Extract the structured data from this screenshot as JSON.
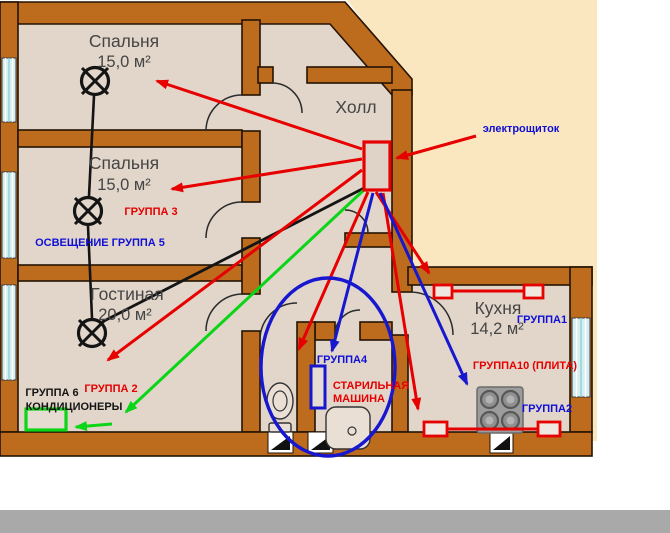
{
  "diagram": {
    "title": "apartment-electrical-wiring-plan",
    "rooms": {
      "bedroom1": {
        "name": "Спальня",
        "area": "15,0 м²"
      },
      "bedroom2": {
        "name": "Спальня",
        "area": "15,0 м²"
      },
      "living": {
        "name": "Гостиная",
        "area": "20,0 м²"
      },
      "hall": {
        "name": "Холл"
      },
      "kitchen": {
        "name": "Кухня",
        "area": "14,2 м²"
      }
    },
    "annotations": {
      "panel": "электрощиток",
      "group3": "ГРУППА 3",
      "lighting_group5": "ОСВЕЩЕНИЕ ГРУППА 5",
      "group2": "ГРУППА 2",
      "group6": "ГРУППА 6",
      "conditioners": "КОНДИЦИОНЕРЫ",
      "group4": "ГРУППА4",
      "washer_line1": "СТАРИЛЬНАЯ",
      "washer_line2": "МАШИНА",
      "group1": "ГРУППА1",
      "group10_stove": "ГРУППА10 (ПЛИТА)",
      "group2_kitchen": "ГРУППА2"
    },
    "colors": {
      "wall": "#bd6b1d",
      "floor": "#e2d6cb",
      "outside": "#fbe7bf",
      "wire_red": "#e60000",
      "wire_blue": "#1717cf",
      "wire_green": "#0ad516",
      "wire_black": "#141414",
      "window_glass": "#d6eef0",
      "bottom_bar": "#a9a9a9",
      "stove_body": "#9c9c9c"
    }
  }
}
